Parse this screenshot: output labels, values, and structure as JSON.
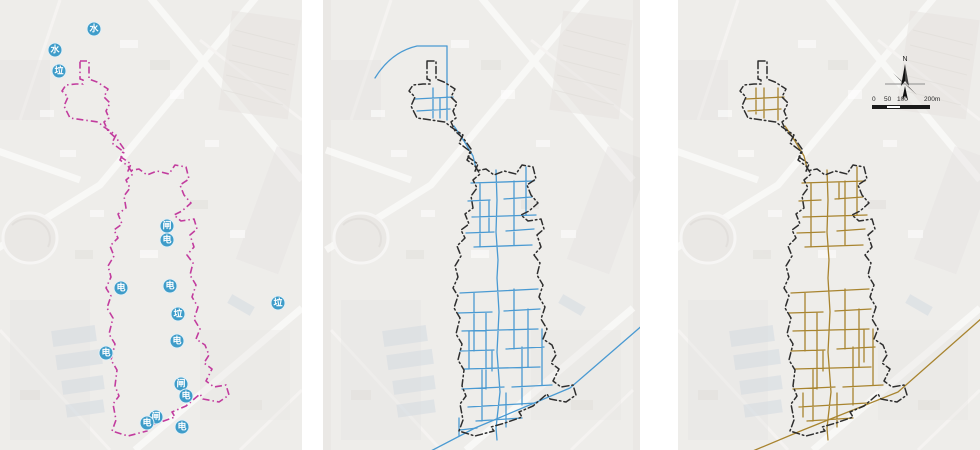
{
  "figure": {
    "type": "map-triptych",
    "compass_label": "N",
    "scale_bar": {
      "labels": [
        "0",
        "50",
        "100",
        "200m"
      ]
    }
  },
  "colors": {
    "boundary_magenta": "#c23c9e",
    "boundary_black": "#2e2e2e",
    "network_blue": "#4a9ad2",
    "network_brown": "#a8842f",
    "marker_blue": "#3e9cc9",
    "marker_text": "#ffffff",
    "compass_black": "#111111"
  },
  "panels": [
    {
      "id": "facility-markers",
      "markers": [
        {
          "label": "水",
          "x": 94,
          "y": 29
        },
        {
          "label": "水",
          "x": 55,
          "y": 50
        },
        {
          "label": "垃",
          "x": 59,
          "y": 71
        },
        {
          "label": "闸",
          "x": 167,
          "y": 226
        },
        {
          "label": "电",
          "x": 167,
          "y": 240
        },
        {
          "label": "电",
          "x": 121,
          "y": 288
        },
        {
          "label": "电",
          "x": 170,
          "y": 286
        },
        {
          "label": "垃",
          "x": 278,
          "y": 303
        },
        {
          "label": "垃",
          "x": 178,
          "y": 314
        },
        {
          "label": "电",
          "x": 177,
          "y": 341
        },
        {
          "label": "电",
          "x": 106,
          "y": 353
        },
        {
          "label": "闸",
          "x": 181,
          "y": 384
        },
        {
          "label": "电",
          "x": 186,
          "y": 396
        },
        {
          "label": "闸",
          "x": 156,
          "y": 417
        },
        {
          "label": "电",
          "x": 147,
          "y": 423
        },
        {
          "label": "电",
          "x": 182,
          "y": 427
        }
      ]
    },
    {
      "id": "blue-network"
    },
    {
      "id": "brown-network"
    }
  ],
  "geometry": {
    "boundary_d": "M80,61 L89,61 L89,79 L97,82 L108,89 L104,97 L110,103 L106,111 L109,118 L104,122 L108,131 L117,139 L124,149 L121,157 L131,164 L128,171 L139,169 L147,175 L157,171 L169,174 L175,165 L186,167 L189,179 L180,185 L184,195 L191,203 L182,211 L174,215 L181,221 L194,219 L197,229 L190,235 L194,247 L187,255 L193,263 L190,275 L196,285 L192,297 L198,307 L194,319 L200,329 L196,339 L205,345 L209,355 L204,363 L212,369 L206,381 L214,387 L226,385 L229,395 L219,402 L203,399 L200,394 L186,406 L172,412 L175,417 L158,423 L144,427 L147,431 L128,436 L112,431 L116,420 L113,404 L119,396 L115,386 L117,370 L111,360 L115,344 L109,334 L113,318 L107,308 L111,296 L106,288 L111,277 L108,266 L114,256 L110,246 L118,238 L114,230 L122,224 L118,214 L126,208 L124,196 L130,188 L126,180 L133,174 L128,166 L120,160 L124,152 L112,143 L116,135 L104,127 L98,122 L70,118 L64,106 L68,97 L62,91 L66,85 L76,84 L83,84 L83,80 L80,79 Z",
    "network_blue_d": "M86,88 L86,118 M100,46 L100,120 M68,99 L106,97 M70,111 L103,109 M93,98 L93,118 M107,126 L117,141 L126,156 L129,168 M149,170 L150,200 L149,232 L151,260 M124,183 L187,181 M121,201 L143,200 M157,199 L185,197 M125,217 L189,215 M119,233 L147,232 M159,231 L187,229 M127,247 L185,245 M133,183 L133,247 M167,181 L167,245 M179,167 L179,215 M142,201 L142,232 M151,260 L150,278 M150,278 L152,312 L150,352 L153,392 L149,428 L150,440 M113,293 L191,289 M111,313 L145,312 M157,311 L193,309 M115,331 L191,329 M113,351 L147,350 M159,349 L197,347 M117,369 L193,367 M115,389 L157,387 M165,387 L205,385 M121,407 L189,403 M129,421 L175,418 M127,293 L127,351 M139,313 L139,389 M167,289 L167,349 M181,309 L181,367 M135,369 L135,421 M175,347 L175,405 M195,329 L195,385 M159,393 L159,427 M145,351 L145,371 M122,331 L122,369 M112,418 L112,436 M113,430 L130,428",
    "network_brown_d": "M78,88 L78,114 M86,88 L86,118 M100,88 L100,120 M68,99 L106,97 M70,111 L103,109 M107,126 L117,141 L126,156 L129,168 M149,170 L150,200 L149,232 L151,260 M124,183 L187,181 M121,201 L143,200 M157,199 L185,197 M161,183 L161,199 M125,217 L189,215 M119,233 L147,232 M159,231 L187,229 M127,247 L185,245 M133,183 L133,247 M167,181 L167,245 M179,167 L179,215 M151,260 L150,278 M150,278 L152,312 L150,352 L153,392 L149,428 L150,440 M113,293 L191,289 M111,313 L145,312 M157,311 L193,309 M115,331 L191,329 M113,351 L147,350 M159,349 L197,347 M117,369 L193,367 M115,389 L157,387 M165,387 L205,385 M121,407 L189,403 M129,421 L175,418 M127,293 L127,351 M139,313 L139,389 M167,289 L167,349 M181,309 L181,367 M135,369 L135,421 M175,347 L175,405 M195,329 L195,385 M186,330 L186,362 M125,393 L125,417 M159,393 L159,427 M145,351 L145,371",
    "curve_blue_d": "M28,78 Q44,52 70,46 L100,46",
    "river_blue_d": "M80,453 L128,428 L223,388 L320,304",
    "river_brown_d": "M70,453 L125,430 L220,392 L304,318"
  }
}
